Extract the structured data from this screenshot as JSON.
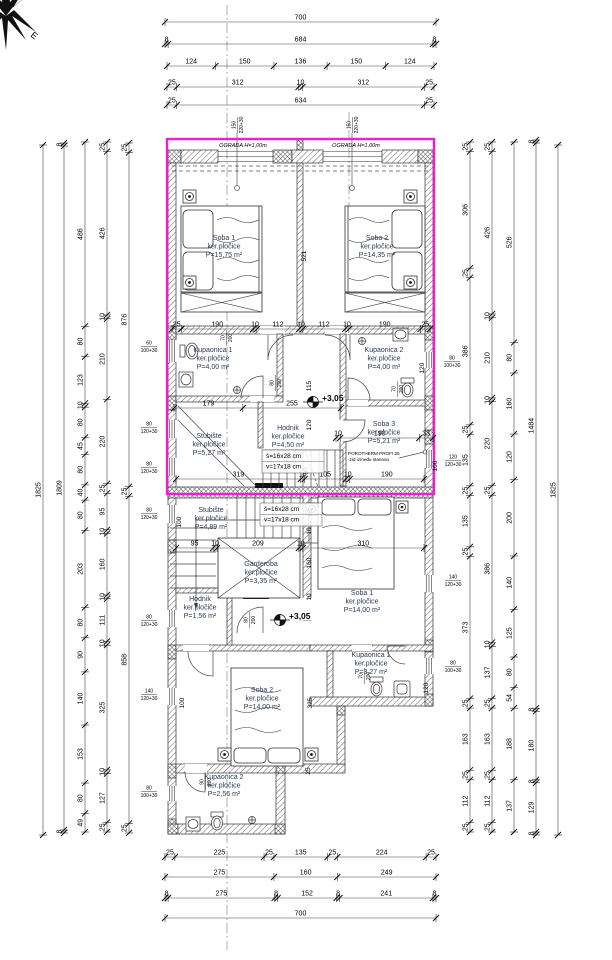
{
  "drawing": {
    "accent_color": "#ec1fd2",
    "compass_label": "E",
    "ograda_labels": [
      {
        "t": "OGRADA H=1,00m",
        "x": 243,
        "y": 147
      },
      {
        "t": "OGRADA H=1,00m",
        "x": 356,
        "y": 147
      }
    ],
    "level_marks": [
      {
        "t": "+3,05",
        "x": 322,
        "y": 401
      },
      {
        "t": "+3,05",
        "x": 289,
        "y": 619
      }
    ],
    "stair_specs": [
      {
        "line1": "š=16x28 cm",
        "line2": "v=17x18 cm",
        "x": 266,
        "y": 458
      },
      {
        "line1": "š=16x28 cm",
        "line2": "v=17x18 cm",
        "x": 264,
        "y": 511
      }
    ],
    "porotherm_note": {
      "line1": "POROTHERM PROFI 25",
      "line2": "-zid između stanova",
      "x": 348,
      "y": 455
    },
    "rooms": [
      {
        "name": "Soba 1",
        "material": "ker.pločice",
        "area": "P=15,75 m²",
        "x": 224,
        "y": 240
      },
      {
        "name": "Soba 2",
        "material": "ker.pločice",
        "area": "P=14,35 m²",
        "x": 377,
        "y": 240
      },
      {
        "name": "Kupaonica 1",
        "material": "ker.pločice",
        "area": "P=4,00 m²",
        "x": 213,
        "y": 352
      },
      {
        "name": "Kupaonica 2",
        "material": "ker.pločice",
        "area": "P=4,00 m²",
        "x": 384,
        "y": 352
      },
      {
        "name": "Hodnik",
        "material": "ker.pločice",
        "area": "P=4,50 m²",
        "x": 288,
        "y": 430
      },
      {
        "name": "Soba 3",
        "material": "ker.pločice",
        "area": "P=5,21 m²",
        "x": 384,
        "y": 426
      },
      {
        "name": "Stubište",
        "material": "ker.pločice",
        "area": "P=5,27 m²",
        "x": 209,
        "y": 438
      },
      {
        "name": "Stubište",
        "material": "ker.pločice",
        "area": "P=4,89 m²",
        "x": 211,
        "y": 512
      },
      {
        "name": "Garderoba",
        "material": "ker.pločice",
        "area": "P=3,35 m²",
        "x": 261,
        "y": 566
      },
      {
        "name": "Soba 1",
        "material": "ker.pločice",
        "area": "P=14,00 m²",
        "x": 362,
        "y": 595
      },
      {
        "name": "Hodnik",
        "material": "ker.pločiče",
        "area": "P=1,56 m²",
        "x": 200,
        "y": 601
      },
      {
        "name": "Kupaonica 1",
        "material": "ker.pločice",
        "area": "P=3,27 m²",
        "x": 371,
        "y": 657
      },
      {
        "name": "Soba 2",
        "material": "ker.pločice",
        "area": "P=14,00 m²",
        "x": 262,
        "y": 692
      },
      {
        "name": "Kupaonica 2",
        "material": "ker.pločice",
        "area": "P=2,56 m²",
        "x": 224,
        "y": 779
      }
    ],
    "dim_rows": [
      {
        "y": 22,
        "x0": 165,
        "x1": 436,
        "values": [
          700
        ]
      },
      {
        "y": 44,
        "x0": 165,
        "x1": 436,
        "values": [
          8,
          684,
          8
        ]
      },
      {
        "y": 66,
        "x0": 167,
        "x1": 434,
        "values": [
          124,
          150,
          136,
          150,
          124
        ]
      },
      {
        "y": 87,
        "x0": 167,
        "x1": 434,
        "values": [
          25,
          312,
          10,
          312,
          25
        ]
      },
      {
        "y": 105,
        "x0": 167,
        "x1": 434,
        "values": [
          25,
          634,
          25
        ]
      },
      {
        "y": 329,
        "x0": 172,
        "x1": 430,
        "values": [
          25,
          190,
          10,
          112,
          10,
          112,
          10,
          190,
          25
        ]
      },
      {
        "y": 408,
        "x0": 174,
        "x1": 341,
        "values": [
          179,
          255
        ]
      },
      {
        "y": 438,
        "x0": 336,
        "x1": 433,
        "values": [
          10,
          190,
          33
        ]
      },
      {
        "y": 479,
        "x0": 176,
        "x1": 424,
        "values": [
          319,
          10,
          105,
          10,
          190
        ]
      },
      {
        "y": 548,
        "x0": 176,
        "x1": 424,
        "values": [
          95,
          10,
          209,
          10,
          310
        ]
      },
      {
        "y": 857,
        "x0": 165,
        "x1": 436,
        "values": [
          25,
          225,
          25,
          135,
          25,
          224,
          25
        ]
      },
      {
        "y": 877,
        "x0": 165,
        "x1": 436,
        "values": [
          275,
          160,
          249
        ]
      },
      {
        "y": 898,
        "x0": 165,
        "x1": 436,
        "values": [
          8,
          275,
          8,
          152,
          8,
          241,
          8
        ]
      },
      {
        "y": 918,
        "x0": 165,
        "x1": 436,
        "values": [
          700
        ]
      }
    ],
    "dim_cols": [
      {
        "x": 43,
        "y0": 145,
        "y1": 835,
        "values": [
          1825
        ]
      },
      {
        "x": 64,
        "y0": 143,
        "y1": 833,
        "values": [
          8,
          1809,
          8
        ]
      },
      {
        "x": 85,
        "y0": 142,
        "y1": 832,
        "values": [
          486,
          80,
          123,
          10,
          80,
          45,
          80,
          40,
          80,
          203,
          80,
          90,
          140,
          153,
          80,
          49
        ]
      },
      {
        "x": 107,
        "y0": 142,
        "y1": 832,
        "values": [
          25,
          426,
          10,
          210,
          220,
          25,
          95,
          10,
          160,
          10,
          111,
          10,
          325,
          10,
          127,
          25
        ]
      },
      {
        "x": 129,
        "y0": 143,
        "y1": 833,
        "values": [
          25,
          876,
          25,
          858,
          25
        ]
      },
      {
        "x": 470,
        "y0": 142,
        "y1": 832,
        "values": [
          25,
          306,
          25,
          386,
          25,
          135,
          25,
          135,
          25,
          373,
          25,
          163,
          25,
          112,
          25
        ]
      },
      {
        "x": 492,
        "y0": 142,
        "y1": 832,
        "values": [
          25,
          426,
          10,
          210,
          10,
          220,
          25,
          386,
          10,
          137,
          25,
          163,
          25,
          112,
          25
        ]
      },
      {
        "x": 514,
        "y0": 142,
        "y1": 832,
        "values": [
          526,
          80,
          160,
          120,
          200,
          140,
          125,
          80,
          54,
          188,
          137
        ]
      },
      {
        "x": 536,
        "y0": 140,
        "y1": 835,
        "values": [
          8,
          1484,
          8,
          180,
          8,
          129,
          8
        ]
      },
      {
        "x": 558,
        "y0": 145,
        "y1": 835,
        "values": [
          1825
        ]
      }
    ],
    "free_labels": [
      {
        "t": "521",
        "x": 306,
        "y": 256,
        "rot": true
      },
      {
        "t": "115",
        "x": 311,
        "y": 386,
        "rot": true
      },
      {
        "t": "120",
        "x": 311,
        "y": 425,
        "rot": true
      },
      {
        "t": "90",
        "x": 308,
        "y": 471,
        "rot": true
      },
      {
        "t": "95",
        "x": 312,
        "y": 513,
        "rot": true
      },
      {
        "t": "10",
        "x": 311,
        "y": 531,
        "rot": true
      },
      {
        "t": "160",
        "x": 311,
        "y": 563,
        "rot": true
      },
      {
        "t": "10",
        "x": 311,
        "y": 597,
        "rot": true
      },
      {
        "t": "325",
        "x": 312,
        "y": 703,
        "rot": true
      },
      {
        "t": "25",
        "x": 310,
        "y": 771,
        "rot": true
      },
      {
        "t": "100",
        "x": 181,
        "y": 522,
        "rot": true
      },
      {
        "t": "100",
        "x": 184,
        "y": 703,
        "rot": true
      },
      {
        "t": "120",
        "x": 428,
        "y": 688,
        "rot": true
      },
      {
        "t": "120",
        "x": 424,
        "y": 368,
        "rot": true
      },
      {
        "t": "100",
        "x": 437,
        "y": 466,
        "rot": true
      }
    ],
    "opening_specs": [
      {
        "w": "60",
        "h": "100+30",
        "x": 149,
        "y": 346
      },
      {
        "w": "80",
        "h": "120+30",
        "x": 149,
        "y": 427
      },
      {
        "w": "80",
        "h": "120+30",
        "x": 149,
        "y": 467
      },
      {
        "w": "80",
        "h": "120+30",
        "x": 149,
        "y": 513
      },
      {
        "w": "80",
        "h": "120+30",
        "x": 149,
        "y": 620
      },
      {
        "w": "140",
        "h": "120+30",
        "x": 149,
        "y": 694
      },
      {
        "w": "80",
        "h": "100+30",
        "x": 149,
        "y": 791
      },
      {
        "w": "80",
        "h": "100+30",
        "x": 452,
        "y": 361
      },
      {
        "w": "120",
        "h": "120+30",
        "x": 453,
        "y": 460
      },
      {
        "w": "140",
        "h": "120+30",
        "x": 453,
        "y": 580
      },
      {
        "w": "80",
        "h": "100+30",
        "x": 453,
        "y": 666
      },
      {
        "w": "150",
        "h": "220+30",
        "x": 237,
        "y": 125,
        "rot": true
      },
      {
        "w": "150",
        "h": "220+30",
        "x": 352,
        "y": 125,
        "rot": true
      },
      {
        "w": "70",
        "h": "200",
        "x": 226,
        "y": 338,
        "rot": true
      },
      {
        "w": "80",
        "h": "200",
        "x": 275,
        "y": 383,
        "rot": true
      },
      {
        "w": "70",
        "h": "200",
        "x": 397,
        "y": 389,
        "rot": true
      },
      {
        "w": "80",
        "h": "200",
        "x": 249,
        "y": 620,
        "rot": true
      },
      {
        "w": "70",
        "h": "200",
        "x": 364,
        "y": 676,
        "rot": true
      },
      {
        "w": "90",
        "h": "200",
        "x": 205,
        "y": 782,
        "rot": true
      }
    ]
  }
}
